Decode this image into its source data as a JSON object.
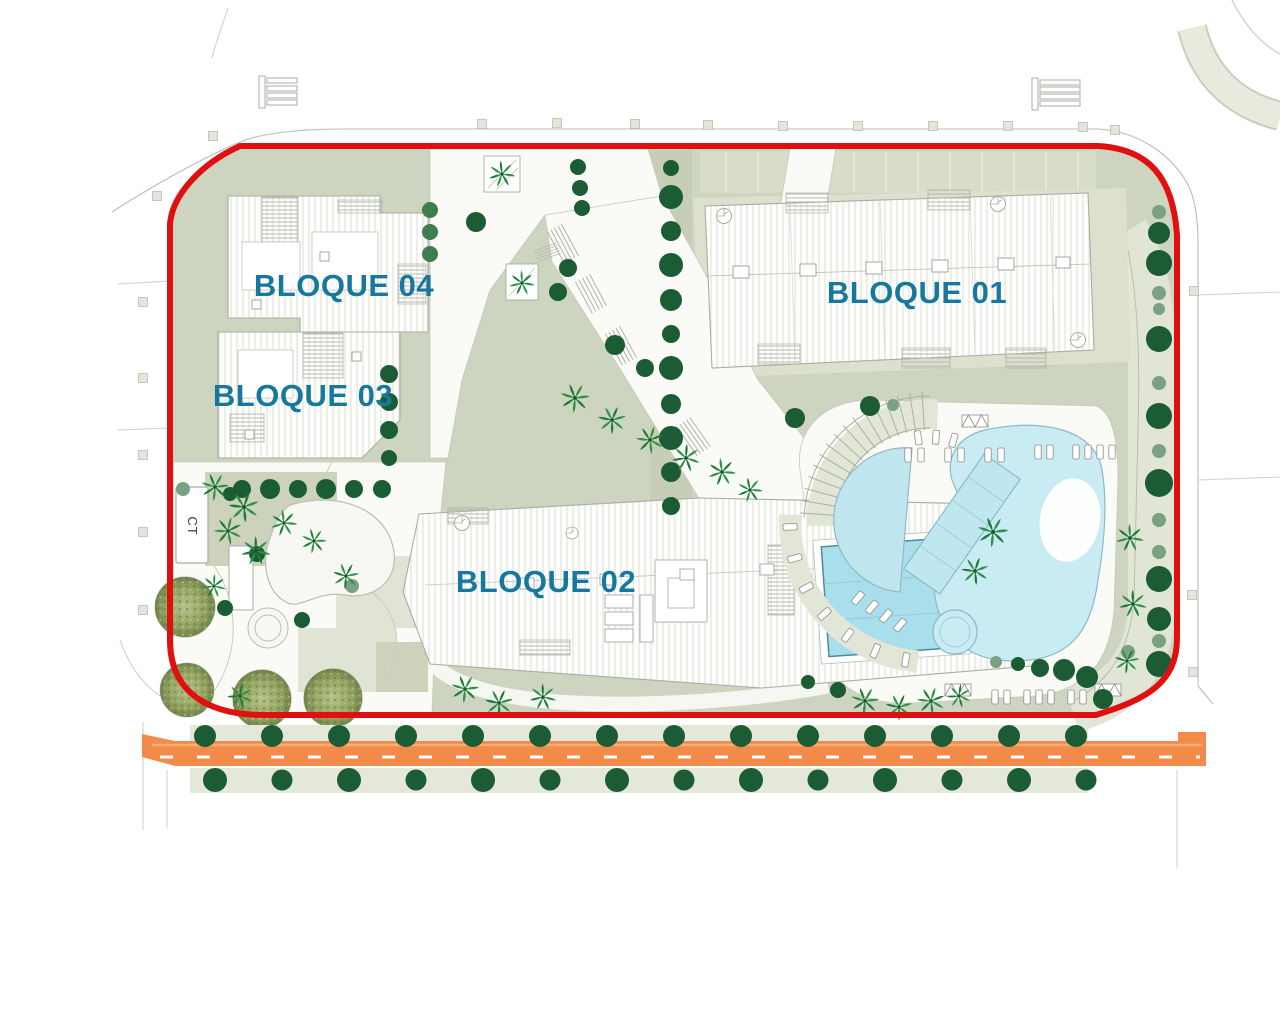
{
  "site_plan": {
    "title_hint": "residential site plan",
    "buildings": [
      {
        "id": "bloque_01",
        "label": "BLOQUE 01"
      },
      {
        "id": "bloque_02",
        "label": "BLOQUE 02"
      },
      {
        "id": "bloque_03",
        "label": "BLOQUE 03"
      },
      {
        "id": "bloque_04",
        "label": "BLOQUE 04"
      }
    ],
    "transformer_label": "CT",
    "colors": {
      "boundary_red": "#e01010",
      "label_teal": "#17789e",
      "landscape_green": "#cdd4bf",
      "pale_pad_green": "#e1e5d5",
      "strip_green": "#c3ccb1",
      "tree_dark_green": "#1b5c34",
      "tree_mid_green": "#3f7d4e",
      "tree_sage_green": "#7aa183",
      "palm_green": "#2f9047",
      "mottled_olive": "#94a562",
      "pool_blue": "#c9ebf3",
      "rooftop_pool_blue": "#a9dfec",
      "road_orange": "#f28a4a",
      "road_stripe_orange": "#f7ad76",
      "dash_white": "#ffffff",
      "curb_gray": "#b9bdb2",
      "roof_outline_gray": "#a9ada3",
      "plaza_white": "#fafbf7"
    },
    "icons": {
      "tree": "tree-icon",
      "shrub": "shrub-icon",
      "palm": "palm-tree-icon",
      "textured_tree": "textured-tree-icon",
      "street_marker": "street-marker-icon",
      "sunbed": "sunbed-icon",
      "pergola": "pergola-icon",
      "spiral_stair": "spiral-stair-icon"
    }
  }
}
